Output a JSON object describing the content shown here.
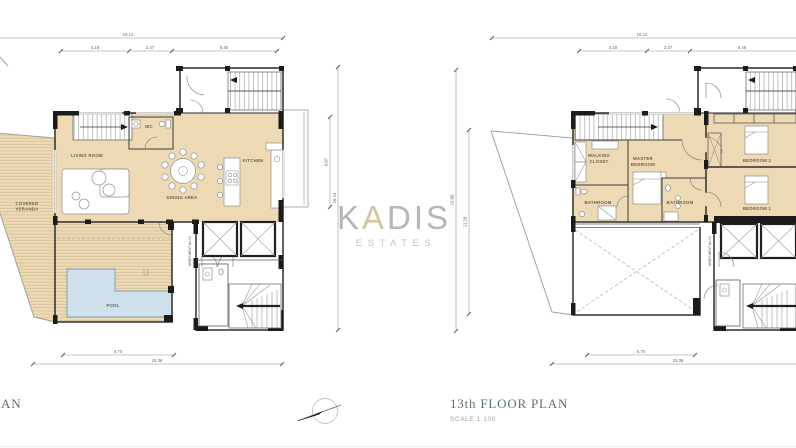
{
  "watermark": {
    "k": "K",
    "a": "A",
    "dis": "DIS",
    "subtitle": "ESTATES"
  },
  "plans": {
    "left": {
      "caption_fragment": "AN",
      "apartment_label": "APARTMENT No.12",
      "rooms": {
        "living_room": "LIVING ROOM",
        "dining_area": "DINING AREA",
        "kitchen": "KITCHEN",
        "wc": "WC",
        "covered_veranda_line1": "COVERED",
        "covered_veranda_line2": "VERANDA",
        "pool": "POOL"
      },
      "dims": {
        "overall_width": "19.12",
        "seg_a": "4.18",
        "seg_b": "2.47",
        "seg_c": "6.45",
        "side_inner": "6.07",
        "side_outer": "16.14",
        "bottom_inner": "6.70",
        "bottom_total": "15.36"
      }
    },
    "right": {
      "caption": "13th FLOOR PLAN",
      "scale_label": "SCALE  1:100",
      "apartment_label": "APARTMENT No.12",
      "rooms": {
        "walking_closet_line1": "WALKING",
        "walking_closet_line2": "CLOSET",
        "master_bedroom_line1": "MASTER",
        "master_bedroom_line2": "BEDROOM",
        "bathroom_left": "BATHROOM",
        "bathroom_center": "BATHROOM",
        "bedroom_2": "BEDROOM 2",
        "bedroom_1": "BEDROOM 1"
      },
      "dims": {
        "overall_width": "19.12",
        "seg_a": "4.18",
        "seg_b": "2.47",
        "seg_c": "6.45",
        "side_outer": "16.00",
        "side_inner": "11.28",
        "bottom_inner": "6.70",
        "bottom_total": "15.36"
      }
    }
  },
  "colors": {
    "floor": "#edd9b3",
    "pool": "#cfe0ed",
    "deck_line": "#c9b58c",
    "wall": "#2e2e2e",
    "caption": "#5c6f7a",
    "watermark_gray": "#b6b6b6",
    "watermark_accent": "#d8c49e"
  }
}
